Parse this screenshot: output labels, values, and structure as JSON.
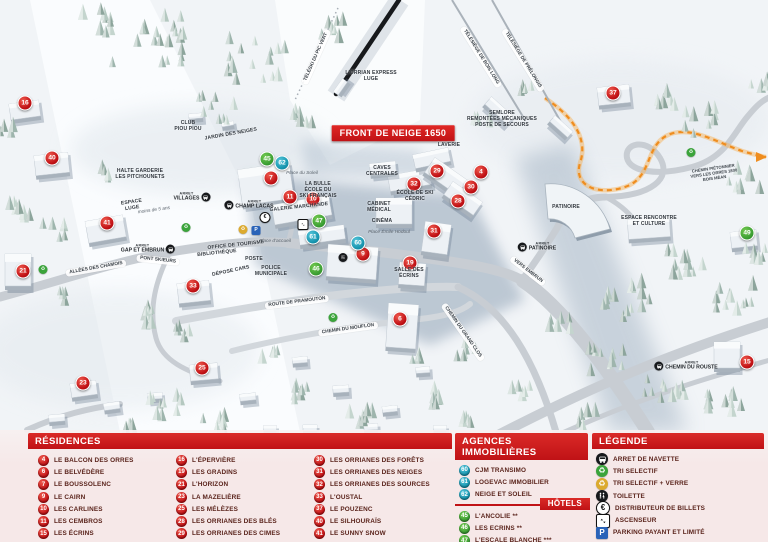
{
  "map": {
    "banner": "FRONT DE NEIGE 1650",
    "stop_prefix": "ARRET",
    "colors": {
      "residence": "#c01014",
      "agence": "#1694ae",
      "hotel": "#3b9e33",
      "banner": "#d6201f",
      "path_pieton": "#ef8d1f"
    },
    "markers": [
      {
        "n": "16",
        "t": "residence",
        "x": 25,
        "y": 103
      },
      {
        "n": "40",
        "t": "residence",
        "x": 52,
        "y": 158
      },
      {
        "n": "41",
        "t": "residence",
        "x": 107,
        "y": 223
      },
      {
        "n": "21",
        "t": "residence",
        "x": 23,
        "y": 271
      },
      {
        "n": "33",
        "t": "residence",
        "x": 193,
        "y": 286
      },
      {
        "n": "23",
        "t": "residence",
        "x": 83,
        "y": 383
      },
      {
        "n": "25",
        "t": "residence",
        "x": 202,
        "y": 368
      },
      {
        "n": "7",
        "t": "residence",
        "x": 271,
        "y": 178
      },
      {
        "n": "11",
        "t": "residence",
        "x": 290,
        "y": 197
      },
      {
        "n": "10",
        "t": "residence",
        "x": 313,
        "y": 199
      },
      {
        "n": "9",
        "t": "residence",
        "x": 363,
        "y": 254
      },
      {
        "n": "19",
        "t": "residence",
        "x": 410,
        "y": 263
      },
      {
        "n": "6",
        "t": "residence",
        "x": 400,
        "y": 319
      },
      {
        "n": "32",
        "t": "residence",
        "x": 414,
        "y": 184
      },
      {
        "n": "29",
        "t": "residence",
        "x": 437,
        "y": 171
      },
      {
        "n": "4",
        "t": "residence",
        "x": 481,
        "y": 172
      },
      {
        "n": "30",
        "t": "residence",
        "x": 471,
        "y": 187
      },
      {
        "n": "28",
        "t": "residence",
        "x": 458,
        "y": 201
      },
      {
        "n": "31",
        "t": "residence",
        "x": 434,
        "y": 231
      },
      {
        "n": "37",
        "t": "residence",
        "x": 613,
        "y": 93
      },
      {
        "n": "15",
        "t": "residence",
        "x": 747,
        "y": 362
      },
      {
        "n": "62",
        "t": "agence",
        "x": 282,
        "y": 163
      },
      {
        "n": "61",
        "t": "agence",
        "x": 313,
        "y": 237
      },
      {
        "n": "60",
        "t": "agence",
        "x": 358,
        "y": 243
      },
      {
        "n": "45",
        "t": "hotel",
        "x": 267,
        "y": 159
      },
      {
        "n": "47",
        "t": "hotel",
        "x": 319,
        "y": 221
      },
      {
        "n": "46",
        "t": "hotel",
        "x": 316,
        "y": 269
      },
      {
        "n": "49",
        "t": "hotel",
        "x": 747,
        "y": 233
      }
    ],
    "labels": [
      {
        "t": "FRONT DE NEIGE 1650",
        "x": 393,
        "y": 133,
        "s": "banner"
      },
      {
        "t": "L'ORRIAN EXPRESS\nLUGE",
        "x": 371,
        "y": 77,
        "s": "place"
      },
      {
        "t": "TÉLÉSKI DU PIC VERT",
        "x": 316,
        "y": 57,
        "s": "lift",
        "r": -66
      },
      {
        "t": "TÉLÉSIÈGE DE BOIS LONG",
        "x": 481,
        "y": 57,
        "s": "lift",
        "r": 58
      },
      {
        "t": "TÉLÉSIÈGE DE PRÉLONGIS",
        "x": 523,
        "y": 60,
        "s": "lift",
        "r": 58
      },
      {
        "t": "SEMLORE\nREMONTÉES MÉCANIQUES\nPOSTE DE SECOURS",
        "x": 502,
        "y": 120,
        "s": "place"
      },
      {
        "t": "LAVERIE",
        "x": 449,
        "y": 146,
        "s": "place"
      },
      {
        "t": "CLUB\nPIOU PIOU",
        "x": 188,
        "y": 127,
        "s": "place"
      },
      {
        "t": "JARDIN DES NEIGES",
        "x": 231,
        "y": 135,
        "s": "place",
        "r": -10
      },
      {
        "t": "HALTE GARDERIE\nLES PITCHOUNETS",
        "x": 140,
        "y": 175,
        "s": "place"
      },
      {
        "t": "ESPACE\nLUGE",
        "x": 132,
        "y": 206,
        "s": "place",
        "r": -8
      },
      {
        "t": "moins de 5 ans",
        "x": 154,
        "y": 211,
        "s": "italic",
        "r": -8
      },
      {
        "t": "GALERIE MARCHANDE",
        "x": 299,
        "y": 208,
        "s": "place",
        "r": -6
      },
      {
        "t": "LA BULLE\nÉCOLE DU\nSKI FRANÇAIS",
        "x": 318,
        "y": 191,
        "s": "place"
      },
      {
        "t": "Place du Soleil",
        "x": 302,
        "y": 174,
        "s": "italic"
      },
      {
        "t": "CAVES\nCENTRALES",
        "x": 382,
        "y": 172,
        "s": "place"
      },
      {
        "t": "ÉCOLE DE SKI\nCÉDRIC",
        "x": 415,
        "y": 197,
        "s": "place"
      },
      {
        "t": "CABINET\nMÉDICAL",
        "x": 379,
        "y": 208,
        "s": "place"
      },
      {
        "t": "CINÉMA",
        "x": 382,
        "y": 222,
        "s": "place"
      },
      {
        "t": "Place Émile Hodoul",
        "x": 389,
        "y": 233,
        "s": "italic"
      },
      {
        "t": "SALLE DES\nÉCRINS",
        "x": 409,
        "y": 274,
        "s": "place"
      },
      {
        "t": "BIBLIOTHÈQUE",
        "x": 217,
        "y": 254,
        "s": "place",
        "r": -6
      },
      {
        "t": "OFFICE DE TOURISME",
        "x": 236,
        "y": 246,
        "s": "place",
        "r": -6
      },
      {
        "t": "POSTE",
        "x": 254,
        "y": 260,
        "s": "place"
      },
      {
        "t": "DÉPOSE CARS",
        "x": 231,
        "y": 272,
        "s": "place",
        "r": -12
      },
      {
        "t": "POLICE\nMUNICIPALE",
        "x": 271,
        "y": 272,
        "s": "place"
      },
      {
        "t": "Place d'accueil",
        "x": 275,
        "y": 242,
        "s": "italic"
      },
      {
        "t": "PATINOIRE",
        "x": 566,
        "y": 208,
        "s": "place"
      },
      {
        "t": "ESPACE RENCONTRE\nET CULTURE",
        "x": 649,
        "y": 222,
        "s": "place"
      },
      {
        "t": "CHEMIN PIÉTONNIER\nVERS LES ORRES 1800\nBOIS MÉAN",
        "x": 714,
        "y": 174,
        "s": "tiny",
        "r": -8
      },
      {
        "t": "ALLÉES DES CHAMOIS",
        "x": 96,
        "y": 268,
        "s": "road",
        "r": -10
      },
      {
        "t": "PONT SKIEURS",
        "x": 158,
        "y": 260,
        "s": "road",
        "r": 6
      },
      {
        "t": "ROUTE DE PRAMOUTON",
        "x": 297,
        "y": 302,
        "s": "road",
        "r": -7
      },
      {
        "t": "CHEMIN DU MOUFLON",
        "x": 348,
        "y": 329,
        "s": "road",
        "r": -8
      },
      {
        "t": "CHEMIN DU GRAND CLOS",
        "x": 463,
        "y": 332,
        "s": "road",
        "r": 55
      },
      {
        "t": "VERS EMBRUN",
        "x": 528,
        "y": 271,
        "s": "road",
        "r": 38
      }
    ],
    "stops": [
      {
        "name": "VILLAGES",
        "x": 192,
        "y": 197,
        "side": "r"
      },
      {
        "name": "CHAMP LACAS",
        "x": 249,
        "y": 205,
        "side": "l"
      },
      {
        "name": "GAP ET EMBRUN",
        "x": 148,
        "y": 249,
        "side": "r"
      },
      {
        "name": "PATINOIRE",
        "x": 537,
        "y": 247,
        "side": "l"
      },
      {
        "name": "CHEMIN DU ROUSTE",
        "x": 686,
        "y": 366,
        "side": "l"
      }
    ],
    "icons": [
      {
        "k": "recycle-green",
        "x": 186,
        "y": 224
      },
      {
        "k": "recycle-green",
        "x": 43,
        "y": 266
      },
      {
        "k": "recycle-green",
        "x": 333,
        "y": 314
      },
      {
        "k": "recycle-green",
        "x": 691,
        "y": 149
      },
      {
        "k": "recycle-yellow",
        "x": 243,
        "y": 226
      },
      {
        "k": "parking",
        "x": 256,
        "y": 227
      },
      {
        "k": "euro",
        "x": 265,
        "y": 214
      },
      {
        "k": "toilet",
        "x": 343,
        "y": 256
      },
      {
        "k": "elevator",
        "x": 303,
        "y": 223
      }
    ]
  },
  "legend_panel": {
    "residences": {
      "title": "RÉSIDENCES",
      "columns": [
        [
          {
            "n": "4",
            "label": "LE BALCON DES ORRES"
          },
          {
            "n": "6",
            "label": "LE BELVÉDÈRE"
          },
          {
            "n": "7",
            "label": "LE BOUSSOLENC"
          },
          {
            "n": "9",
            "label": "LE CAIRN"
          },
          {
            "n": "10",
            "label": "LES CARLINES"
          },
          {
            "n": "11",
            "label": "LES CEMBROS"
          },
          {
            "n": "15",
            "label": "LES ÉCRINS"
          }
        ],
        [
          {
            "n": "16",
            "label": "L'ÉPERVIÈRE"
          },
          {
            "n": "19",
            "label": "LES GRADINS"
          },
          {
            "n": "21",
            "label": "L'HORIZON"
          },
          {
            "n": "23",
            "label": "LA MAZELIÈRE"
          },
          {
            "n": "25",
            "label": "LES MÉLÈZES"
          },
          {
            "n": "28",
            "label": "LES ORRIANES DES BLÉS"
          },
          {
            "n": "29",
            "label": "LES ORRIANES DES CIMES"
          }
        ],
        [
          {
            "n": "30",
            "label": "LES ORRIANES DES FORÊTS"
          },
          {
            "n": "31",
            "label": "LES ORRIANES DES NEIGES"
          },
          {
            "n": "32",
            "label": "LES ORRIANES DES SOURCES"
          },
          {
            "n": "33",
            "label": "L'OUSTAL"
          },
          {
            "n": "37",
            "label": "LE POUZENC"
          },
          {
            "n": "40",
            "label": "LE SILHOURAÏS"
          },
          {
            "n": "41",
            "label": "LE SUNNY SNOW"
          }
        ]
      ]
    },
    "agences": {
      "title": "AGENCES IMMOBILIÈRES",
      "items": [
        {
          "n": "60",
          "label": "CJM TRANSIMO"
        },
        {
          "n": "61",
          "label": "LOGEVAC IMMOBILIER"
        },
        {
          "n": "62",
          "label": "NEIGE ET SOLEIL"
        }
      ]
    },
    "hotels": {
      "title": "HÔTELS",
      "items": [
        {
          "n": "45",
          "label": "L'ANCOLIE **"
        },
        {
          "n": "46",
          "label": "LES ECRINS **"
        },
        {
          "n": "47",
          "label": "L'ESCALE BLANCHE ***"
        },
        {
          "n": "49",
          "label": "LES TRAPPEURS **"
        }
      ]
    },
    "legende": {
      "title": "LÉGENDE",
      "items": [
        {
          "icon": "bus",
          "label": "ARRET DE NAVETTE"
        },
        {
          "icon": "recycle-green",
          "label": "TRI SELECTIF"
        },
        {
          "icon": "recycle-yellow",
          "label": "TRI SELECTIF + VERRE"
        },
        {
          "icon": "toilet",
          "label": "TOILETTE"
        },
        {
          "icon": "euro",
          "label": "DISTRIBUTEUR DE BILLETS"
        },
        {
          "icon": "elevator",
          "label": "ASCENSEUR"
        },
        {
          "icon": "parking",
          "label": "PARKING PAYANT ET LIMITÉ"
        }
      ]
    }
  }
}
